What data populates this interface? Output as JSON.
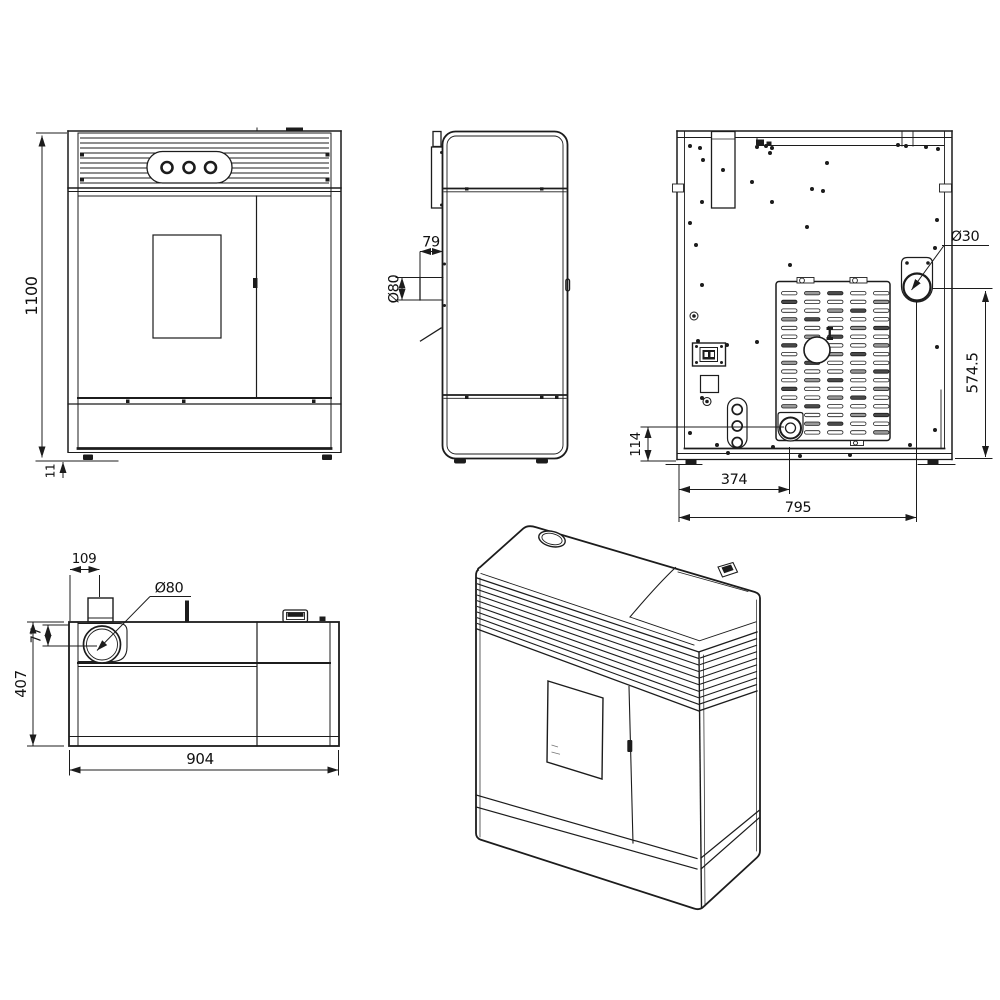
{
  "page": {
    "background": "#ffffff",
    "ink": "#1c1c1c"
  },
  "drawing": {
    "type": "technical-drawing",
    "views": {
      "front": {
        "dim_height": "1100",
        "dim_base_height": "11"
      },
      "side": {
        "dim_flue_rear_offset": "79",
        "dim_flue_diameter": "Ø80"
      },
      "back": {
        "dim_outlet_diameter": "Ø30",
        "dim_outlet_center_height": "574.5",
        "dim_port_center_height": "114",
        "dim_port_offset": "374",
        "dim_overall_width": "795"
      },
      "top": {
        "dim_flue_offset_x": "109",
        "dim_flue_diameter": "Ø80",
        "dim_flue_offset_y": "77",
        "dim_overall_depth": "407",
        "dim_overall_width": "904"
      }
    }
  }
}
